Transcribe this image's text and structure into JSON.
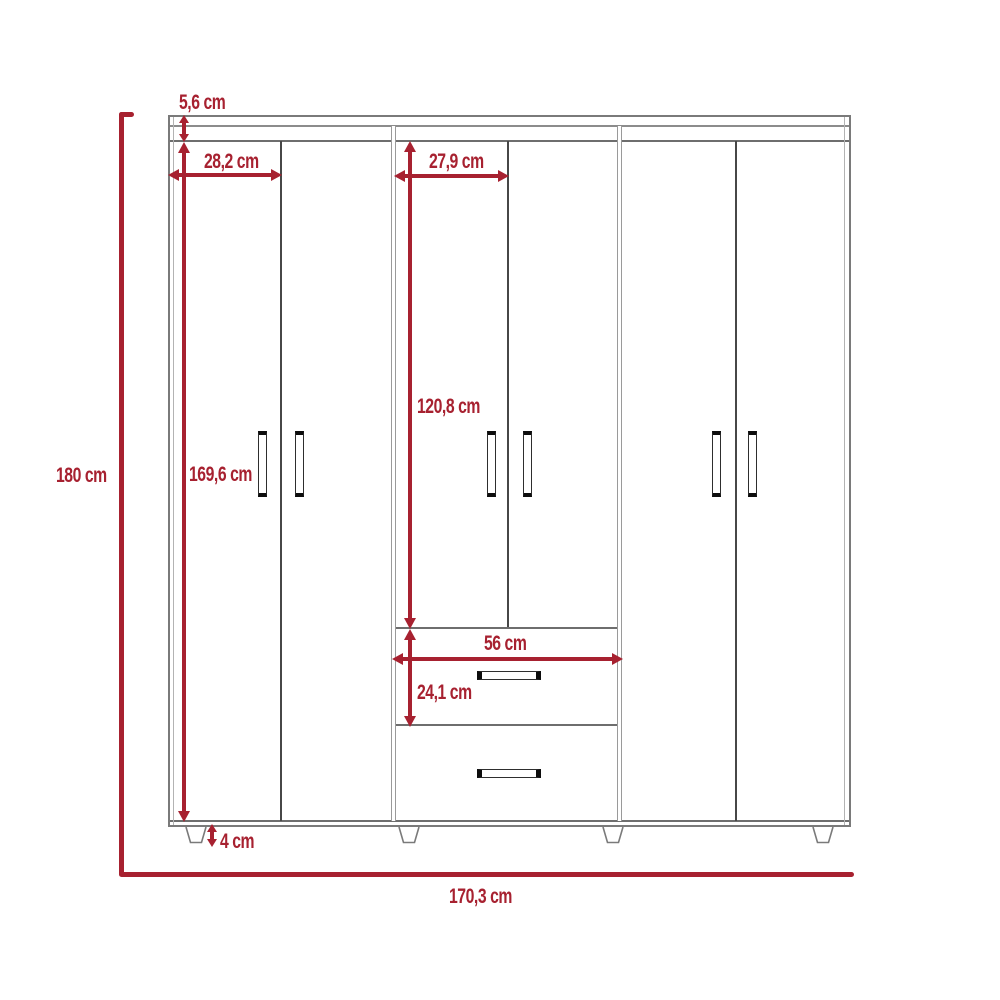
{
  "diagram": {
    "kind": "furniture dimension drawing",
    "subject": "six-door wardrobe with two center drawers, front elevation",
    "colors": {
      "dimension_red": "#a72130",
      "outline_gray": "#7a7a7a",
      "handle_black": "#0d0d0d",
      "background": "#ffffff"
    },
    "structure": {
      "sections": 3,
      "doors": 6,
      "drawers": 2,
      "door_handles": 6,
      "drawer_handles": 2,
      "feet_visible": 4
    },
    "dims": {
      "overall_height": "180 cm",
      "overall_width": "170,3 cm",
      "top_panel": "5,6 cm",
      "side_door_width": "28,2 cm",
      "center_door_width": "27,9 cm",
      "side_door_height": "169,6 cm",
      "center_door_height": "120,8 cm",
      "drawer_width": "56 cm",
      "drawer_height": "24,1 cm",
      "leg_height": "4 cm"
    }
  }
}
